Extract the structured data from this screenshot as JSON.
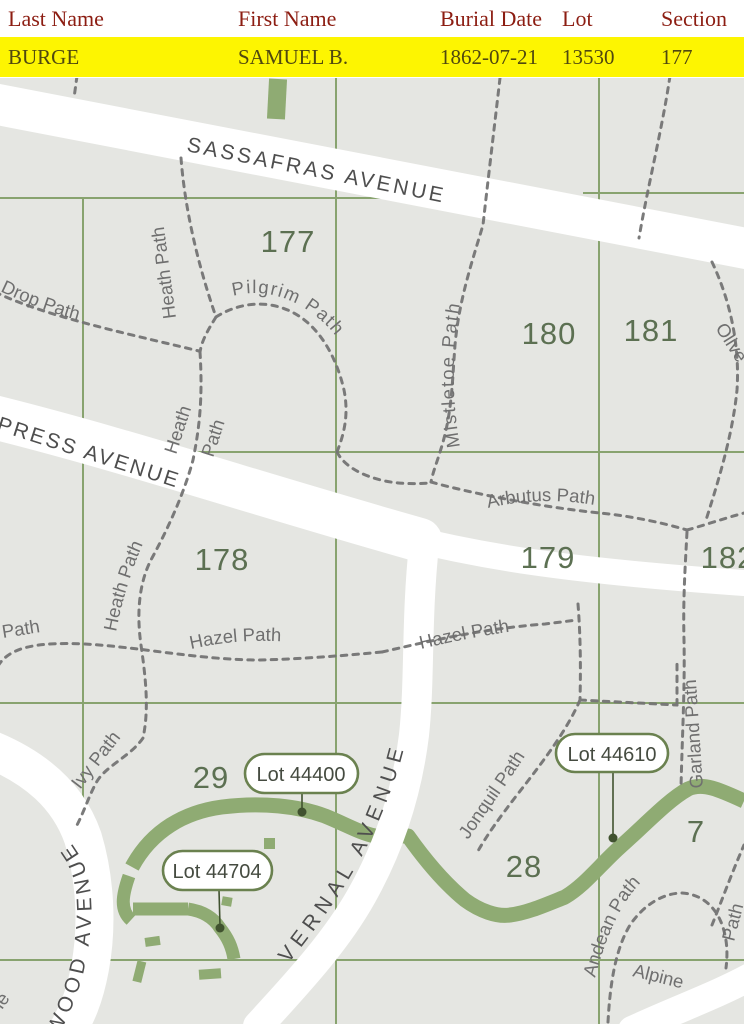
{
  "table": {
    "headers": [
      "Last Name",
      "First Name",
      "Burial Date",
      "Lot",
      "Section"
    ],
    "row": {
      "last_name": "BURGE",
      "first_name": "SAMUEL B.",
      "burial_date": "1862-07-21",
      "lot": "13530",
      "section": "177"
    },
    "highlight_color": "#fdf501",
    "header_text_color": "#8c1d12"
  },
  "map": {
    "sections": {
      "s177": "177",
      "s178": "178",
      "s179": "179",
      "s180": "180",
      "s181": "181",
      "s182": "182",
      "s29": "29",
      "s28": "28",
      "s7": "7"
    },
    "avenues": {
      "sassafras": "SASSAFRAS AVENUE",
      "cypress": "PRESS AVENUE",
      "vernal": "VERNAL AVENUE",
      "wood": "WOOD AVENUE"
    },
    "paths": {
      "drop": "Drop Path",
      "heath_upper": "Heath Path",
      "heath_mid_1": "Heath",
      "heath_mid_2": "Path",
      "heath_lower": "Heath Path",
      "pilgrim": "Pilgrim Path",
      "mistletoe": "Mistletoe Path",
      "arbutus": "Arbutus Path",
      "hazel_fragment": "Path",
      "hazel_west": "Hazel Path",
      "hazel_east": "Hazel Path",
      "ivy": "Ivy Path",
      "jonquil": "Jonquil Path",
      "garland": "Garland Path",
      "andean": "Andean Path",
      "alpine": "Alpine",
      "olive": "Olive",
      "path_fragment_ne": "Path",
      "fragment_sw": "le"
    },
    "lots": [
      {
        "label": "Lot 44400"
      },
      {
        "label": "Lot 44704"
      },
      {
        "label": "Lot 44610"
      }
    ],
    "colors": {
      "background": "#e5e6e2",
      "grid": "#7f9c63",
      "road": "#ffffff",
      "dashed_path": "#747474",
      "green_band": "#8fab73",
      "section_label": "#5c7052",
      "path_label": "#6f6f6f",
      "avenue_label": "#4e4e4e",
      "pill_border": "#6a814f",
      "marker": "#40522f"
    }
  }
}
